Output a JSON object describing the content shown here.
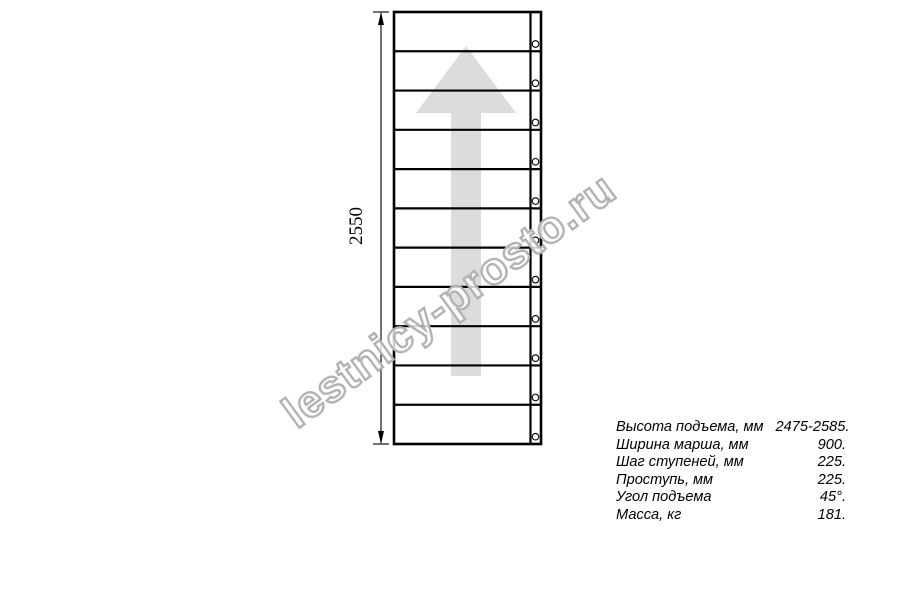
{
  "drawing": {
    "dimension_label": "2550",
    "treads": 11,
    "arrow_direction": "up",
    "colors": {
      "line": "#000000",
      "arrow_fill": "#dcdcdc",
      "watermark_stroke": "#b3b3b3",
      "watermark_fill": "#ffffff"
    }
  },
  "watermark": {
    "text": "lestnicy-prosto.ru"
  },
  "specs": {
    "rows": [
      {
        "label": "Высота подъема, мм",
        "value": "2475-2585."
      },
      {
        "label": "Ширина марша, мм",
        "value": "900."
      },
      {
        "label": "Шаг ступеней, мм",
        "value": "225."
      },
      {
        "label": "Проступь, мм",
        "value": "225."
      },
      {
        "label": "Угол подъема",
        "value": "45°."
      },
      {
        "label": "Масса, кг",
        "value": "181."
      }
    ]
  }
}
